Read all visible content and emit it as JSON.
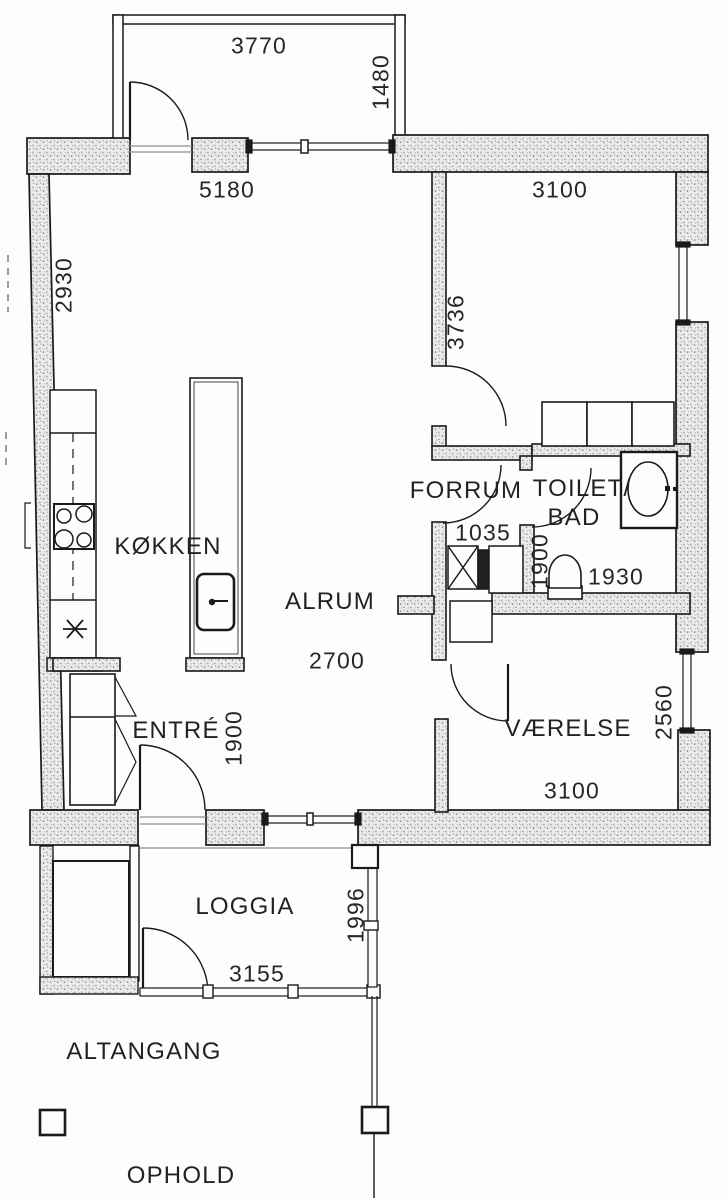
{
  "title": "Apartment floor plan (scanned architectural drawing)",
  "rooms": {
    "kitchen": "KØKKEN",
    "living": "ALRUM",
    "entry": "ENTRÉ",
    "hall": "FORRUM",
    "bath_line1": "TOILET/",
    "bath_line2": "BAD",
    "bedroom": "VÆRELSE",
    "loggia": "LOGGIA",
    "walkway": "ALTANGANG",
    "stay": "OPHOLD"
  },
  "dimensions": {
    "balcony_width": "3770",
    "balcony_depth": "1480",
    "living_width": "5180",
    "top_room_width": "3100",
    "left_wall_height": "2930",
    "top_room_height": "3736",
    "hall_width": "1035",
    "bath_depth": "1900",
    "bath_width": "1930",
    "living_depth": "2700",
    "entry_width": "1900",
    "bedroom_depth": "2560",
    "bedroom_width": "3100",
    "loggia_depth": "1996",
    "loggia_width": "3155"
  },
  "elements": [
    "door-swing",
    "window",
    "wall-hatched",
    "kitchen-counter",
    "cooktop",
    "kitchen-island-sink",
    "wardrobe",
    "washbasin",
    "toilet",
    "railing",
    "column"
  ],
  "colors": {
    "background": "#fdfdfc",
    "ink": "#1a1a1a",
    "wall_fill": "#ebebe9",
    "wall_dot": "#8f8f8f",
    "text": "#262626"
  }
}
